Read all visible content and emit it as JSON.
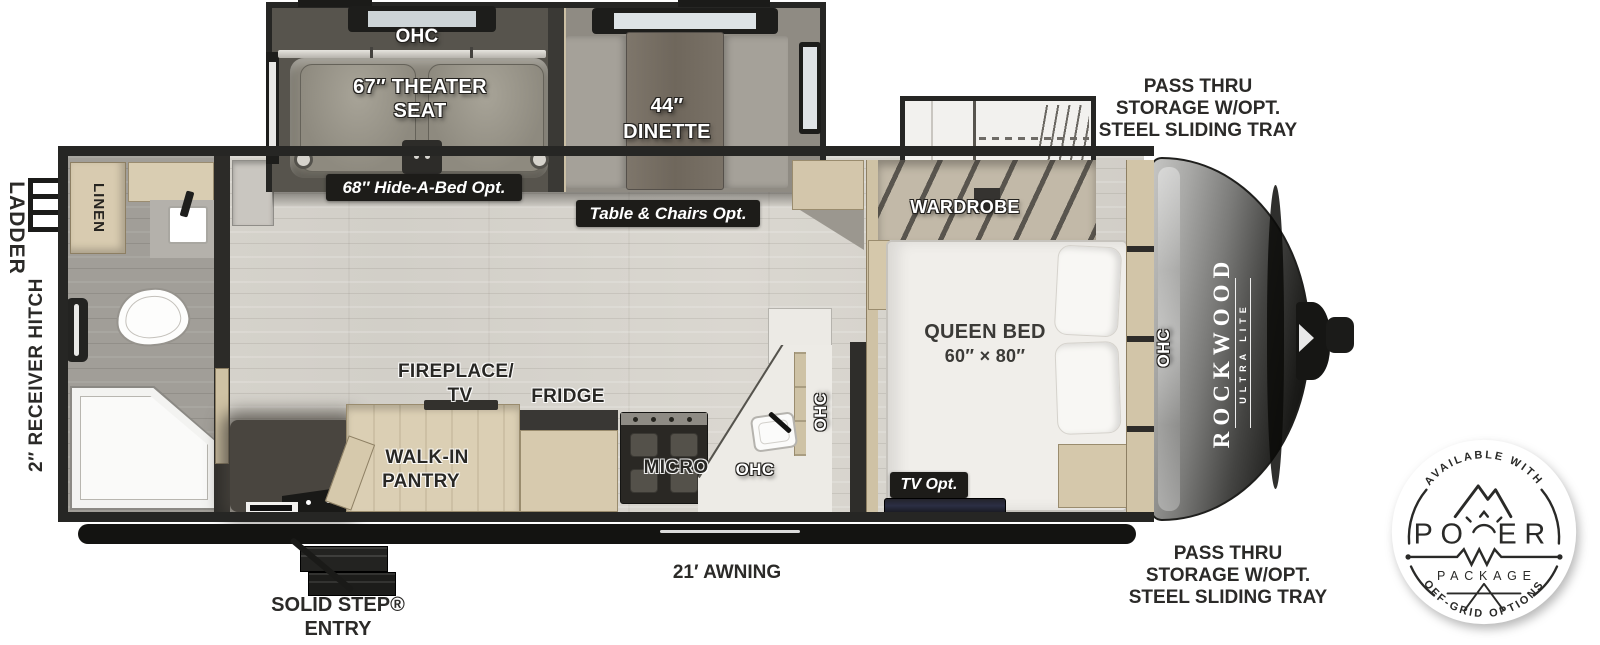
{
  "floorplan": {
    "exterior": {
      "ladder": "LADDER",
      "receiver_hitch": "2″ RECEIVER HITCH",
      "pass_thru_top": [
        "PASS THRU",
        "STORAGE W/OPT.",
        "STEEL SLIDING TRAY"
      ],
      "pass_thru_bottom": [
        "PASS THRU",
        "STORAGE W/OPT.",
        "STEEL SLIDING TRAY"
      ],
      "awning": "21′ AWNING",
      "solid_step_line1": "SOLID STEP®",
      "solid_step_line2": "ENTRY"
    },
    "living_slide": {
      "ohc": "OHC",
      "theater_line1": "67″ THEATER",
      "theater_line2": "SEAT",
      "dinette_line1": "44″",
      "dinette_line2": "DINETTE",
      "hide_a_bed_opt": "68″ Hide-A-Bed Opt.",
      "table_chairs_opt": "Table & Chairs Opt."
    },
    "bath": {
      "linen": "LINEN"
    },
    "kitchen": {
      "fireplace_line1": "FIREPLACE/",
      "fireplace_line2": "TV",
      "fridge": "FRIDGE",
      "pantry_line1": "WALK-IN",
      "pantry_line2": "PANTRY",
      "micro": "MICRO",
      "ohc_lower": "OHC",
      "ohc_upper": "OHC"
    },
    "bedroom": {
      "wardrobe": "WARDROBE",
      "queen_bed_line1": "QUEEN BED",
      "queen_bed_line2": "60″ × 80″",
      "tv_opt": "TV Opt.",
      "ohc": "OHC"
    },
    "brand": {
      "name": "ROCKWOOD",
      "sub": "ULTRA LITE"
    },
    "badge": {
      "available_with": "AVAILABLE WITH",
      "power_left": "PO",
      "power_right": "ER",
      "package": "PACKAGE",
      "off_grid": "OFF-GRID OPTIONS"
    },
    "colors": {
      "wall": "#262624",
      "chip_bg": "#1d1c19",
      "cabinet_tan": "#d8cbb0",
      "wood_floor": "#d6d3cc",
      "slide_floor": "#57544d"
    }
  }
}
